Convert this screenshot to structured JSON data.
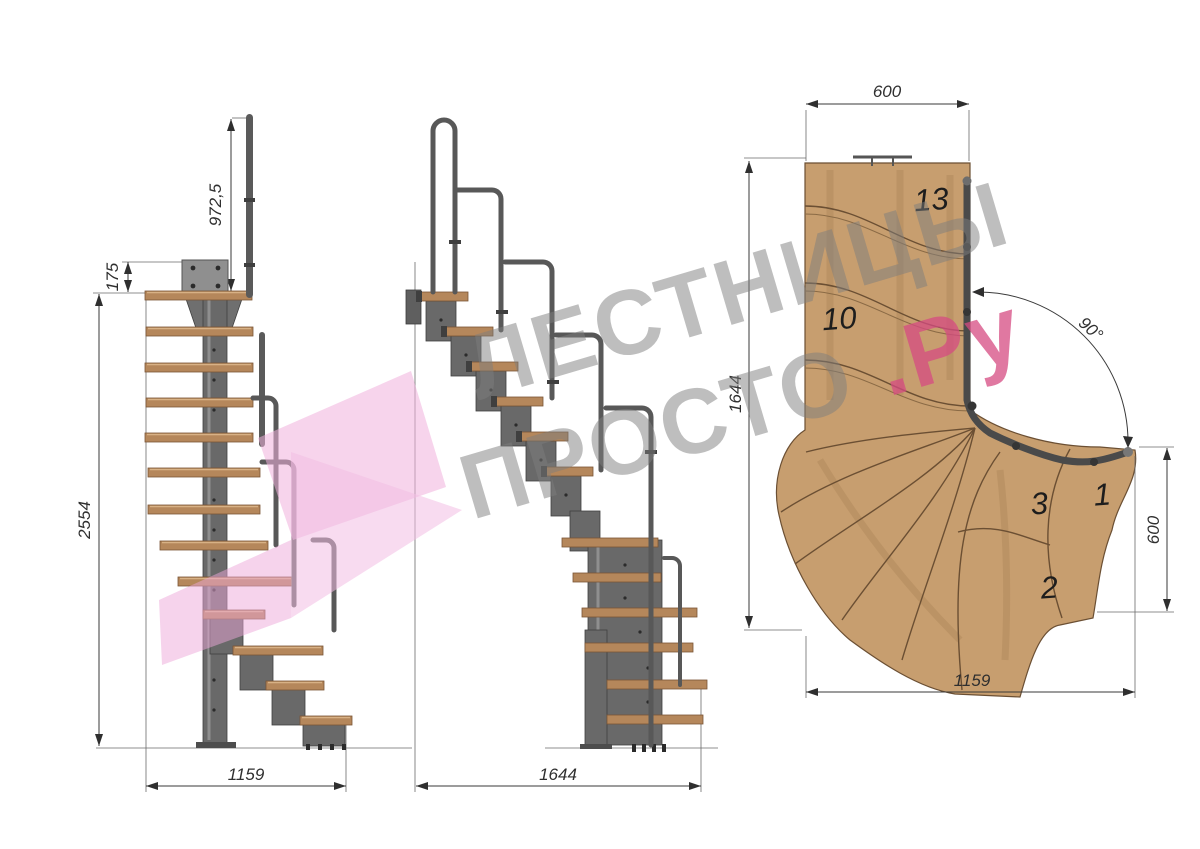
{
  "watermark": {
    "line1": "ЛЕСТНИЦЫ",
    "line2": "ПРОСТО",
    "suffix": ".Ру"
  },
  "views": {
    "side": {
      "dim_handrail_height": "972,5",
      "dim_top_offset": "175",
      "dim_total_height": "2554",
      "dim_width": "1159"
    },
    "front": {
      "dim_length": "1644"
    },
    "plan": {
      "dim_landing_width": "600",
      "dim_length": "1644",
      "dim_turn_angle": "90°",
      "dim_exit_width": "600",
      "dim_width": "1159",
      "labels": {
        "top": "13",
        "mid": "10",
        "s3": "3",
        "s1": "1",
        "s2": "2"
      }
    }
  },
  "colors": {
    "wood": "#c79e6f",
    "wood_edge": "#6b4f33",
    "tread_side": "#b5875b",
    "metal": "#696969",
    "rail": "#585858",
    "dimension": "#2f2f2f",
    "watermark_gray": "#7d7d7d",
    "watermark_pink": "#d64b82",
    "logo_pink": "#f2b9e0"
  }
}
